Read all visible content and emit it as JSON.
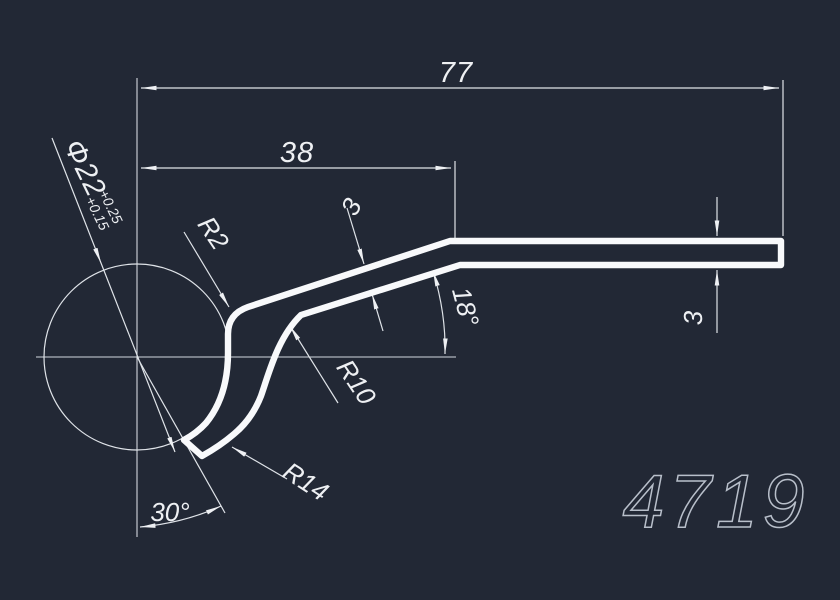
{
  "canvas": {
    "background_color": "#222835",
    "line_color": "#f8f9fb",
    "dim_color": "#eef0f3",
    "part_number_color": "#b8bfca"
  },
  "part": {
    "number": "4719"
  },
  "dims": {
    "overall_length": {
      "label": "77",
      "value": 77
    },
    "upper_segment_length": {
      "label": "38",
      "value": 38
    },
    "strip_thickness": {
      "label": "3",
      "value": 3
    },
    "end_thickness": {
      "label": "3",
      "value": 3
    },
    "slant_angle": {
      "label": "18°",
      "value": 18
    },
    "tip_angle": {
      "label": "30°",
      "value": 30
    },
    "corner_radius": {
      "label": "R2",
      "value": 2
    },
    "bend_radius": {
      "label": "R10",
      "value": 10
    },
    "hook_radius": {
      "label": "R14",
      "value": 14
    },
    "bore_diameter": {
      "label": "Φ22",
      "upper_tolerance": "+0.25",
      "lower_tolerance": "+0.15",
      "value": 22
    }
  }
}
